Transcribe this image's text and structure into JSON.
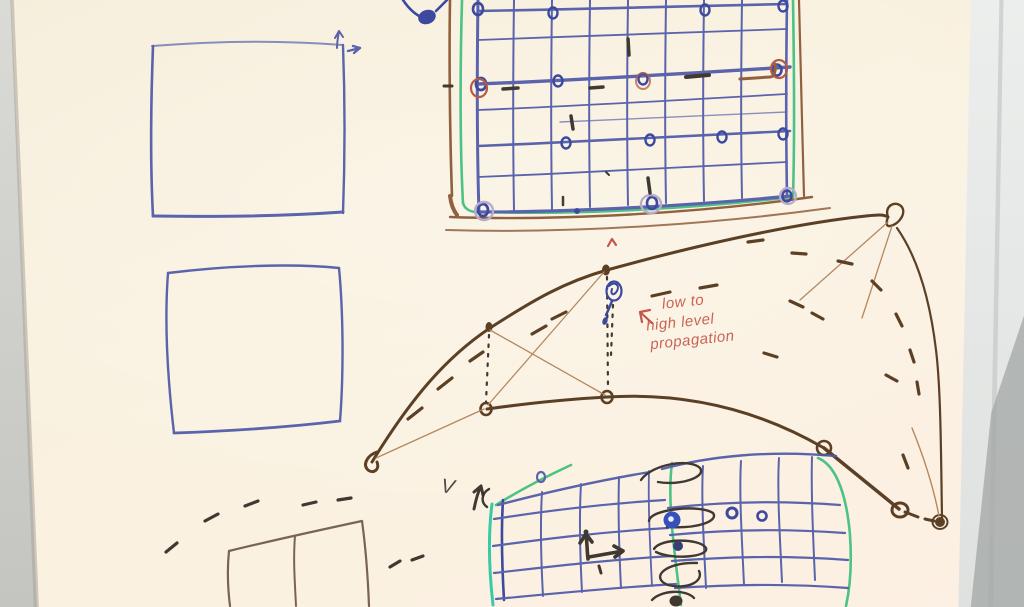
{
  "annotations": {
    "red_note": {
      "line1": "low to",
      "line2": "high level",
      "line3": "propagation"
    },
    "v_label": "V"
  },
  "colors": {
    "whiteboard": "#f9f1de",
    "wall_left": "#d3d3cf",
    "wall_right": "#e5e7e6",
    "pen_blue": "#4e59a8",
    "pen_blue_dark": "#2e3d9b",
    "pen_navy": "#2a3070",
    "pen_green": "#3fbf7f",
    "pen_teal": "#2cc6a3",
    "pen_brown": "#8a5533",
    "pen_brown_light": "#b08055",
    "pen_dark": "#503318",
    "pen_black": "#312c25",
    "pen_red": "#c24a3e",
    "pen_rust": "#b0503a",
    "pen_lavender": "#b4a8c4"
  }
}
